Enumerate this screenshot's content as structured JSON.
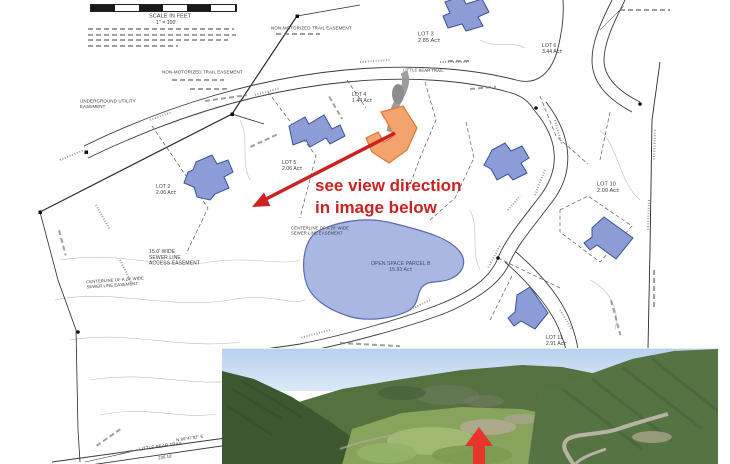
{
  "scale": {
    "label": "SCALE IN FEET",
    "ratio": "1\" = 100'"
  },
  "easements": {
    "trail_top": "NON-MOTORIZED TRAIL EASEMENT",
    "trail_left": "NON-MOTORIZED TRAIL EASEMENT",
    "underground_line1": "UNDERGROUND UTILITY",
    "underground_line2": "EASEMENT",
    "sewer_access_line1": "15.0' WIDE",
    "sewer_access_line2": "SEWER LINE",
    "sewer_access_line3": "ACCESS EASEMENT",
    "sewer_cl_line1": "CENTERLINE OF A 20' WIDE",
    "sewer_cl_line2": "SEWER LINE EASEMENT"
  },
  "lots": [
    {
      "name": "LOT 2",
      "area": "2.06 Ac±"
    },
    {
      "name": "LOT 3",
      "area": "2.85 Ac±"
    },
    {
      "name": "LOT 4",
      "area": "1.44 Ac±"
    },
    {
      "name": "LOT 5",
      "area": "2.06 Ac±"
    },
    {
      "name": "LOT 6",
      "area": "3.44 Ac±"
    },
    {
      "name": "LOT 10",
      "area": "2.00 Ac±"
    },
    {
      "name": "LOT 11",
      "area": "2.91 Ac±"
    }
  ],
  "open_space": {
    "name": "OPEN SPACE PARCEL B",
    "area": "15.93 Ac±"
  },
  "roads": {
    "main_label": "LITTLE BEAR TRAIL",
    "bottom_label": "LITTLE BEAR TRAIL",
    "bottom_bearing": "N 89°47'02\" E",
    "bottom_distance": "236.16'"
  },
  "annotation": {
    "line1": "see view direction",
    "line2": "in image below",
    "color": "#cc2222"
  },
  "colors": {
    "building_fill": "#8c9dd6",
    "building_stroke": "#3a4fa2",
    "open_space_fill": "#aab7e2",
    "open_space_stroke": "#5a68b4",
    "highlight_fill": "#f2a36e",
    "highlight_stroke": "#de7a35",
    "annotation_red": "#cc2222",
    "photo_arrow_red": "#e8352b"
  }
}
